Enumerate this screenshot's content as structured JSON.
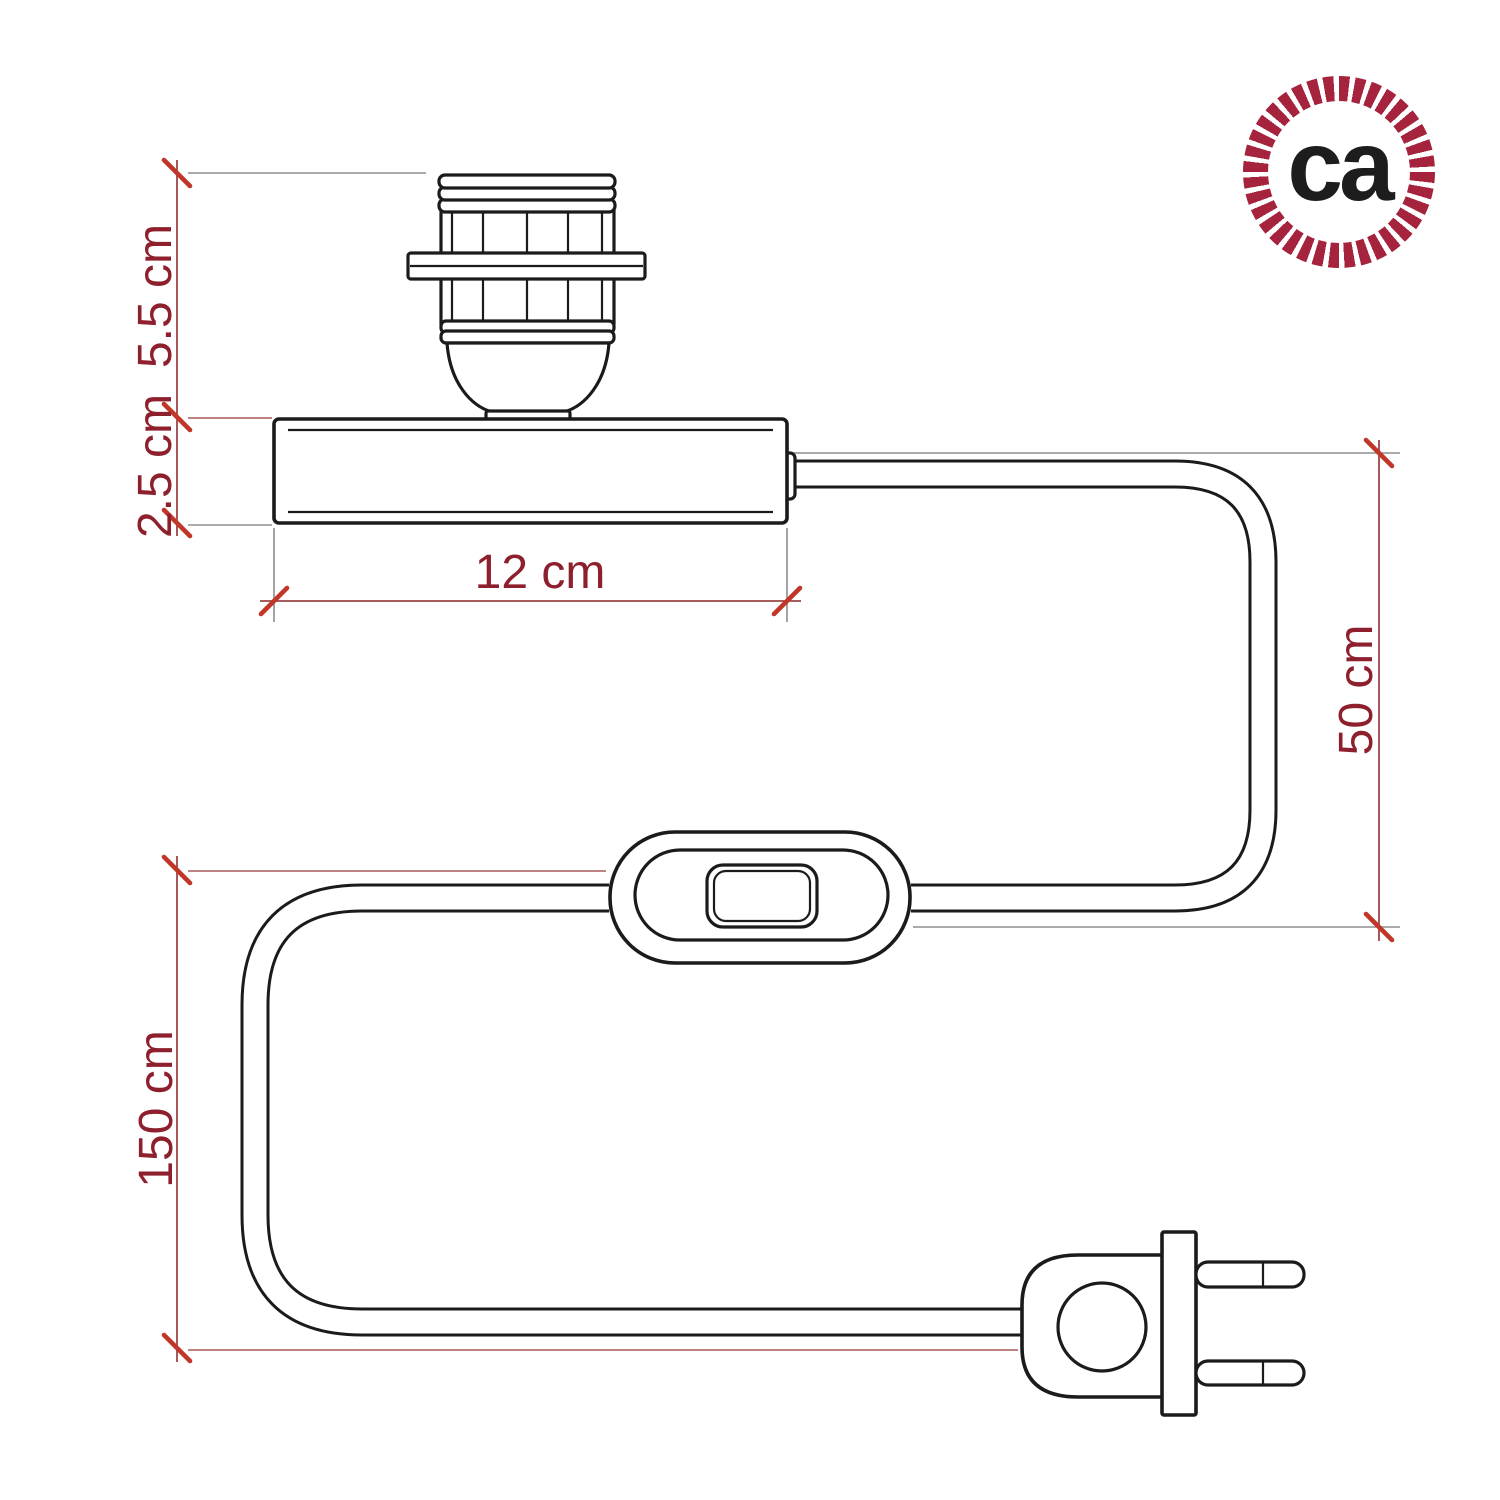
{
  "title": "Table lamp kit dimension diagram",
  "logo": {
    "text": "ca",
    "ring_color": "#a5233c",
    "text_color": "#1d1d1d"
  },
  "dimensions": {
    "socket_height": {
      "label": "5.5 cm"
    },
    "base_height": {
      "label": "2.5 cm"
    },
    "base_width": {
      "label": "12 cm"
    },
    "cable_drop": {
      "label": "50 cm"
    },
    "total_cable_length": {
      "label": "150 cm"
    }
  },
  "parts": {
    "socket": "threaded-lamp-holder-with-shade-ring",
    "base": "rectangular-lamp-base",
    "switch": "inline-rocker-switch",
    "plug": "two-prong-plug",
    "cable": "power-cable"
  },
  "colors": {
    "drawing_line": "#1b1b1b",
    "dimension_line": "#9c4646",
    "extension_line": "#8e8e8e",
    "tick": "#c0372a",
    "label_text": "#8e1f2d",
    "background": "#ffffff"
  }
}
